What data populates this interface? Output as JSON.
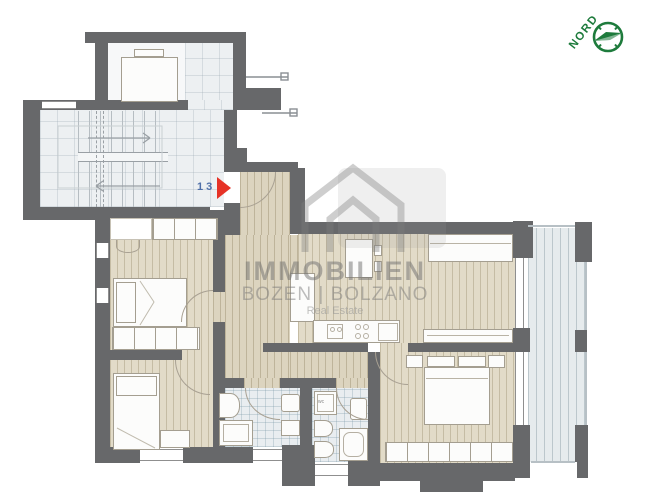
{
  "compass": {
    "label": "NORD"
  },
  "watermark": {
    "brand": "IMMOBILIEN",
    "location": "BOZEN | BOLZANO",
    "tagline": "Real Estate"
  },
  "entrance": {
    "unit_number": "13"
  },
  "labels": {
    "wc": "wc"
  },
  "colors": {
    "wall": "#67686a",
    "wood_floor": "#e2dbc8",
    "hallway_floor": "#dcd4bf",
    "stairwell_floor": "#edf0f2",
    "bathroom_tile": "#e9edf0",
    "balcony_deck": "#e6ebed",
    "furniture": "#fcfcfb",
    "compass_green": "#1e7b3c",
    "entry_arrow_red": "#e63226",
    "unit_number_blue": "#4f6fa8",
    "watermark_gray": "#9a9a9a"
  }
}
